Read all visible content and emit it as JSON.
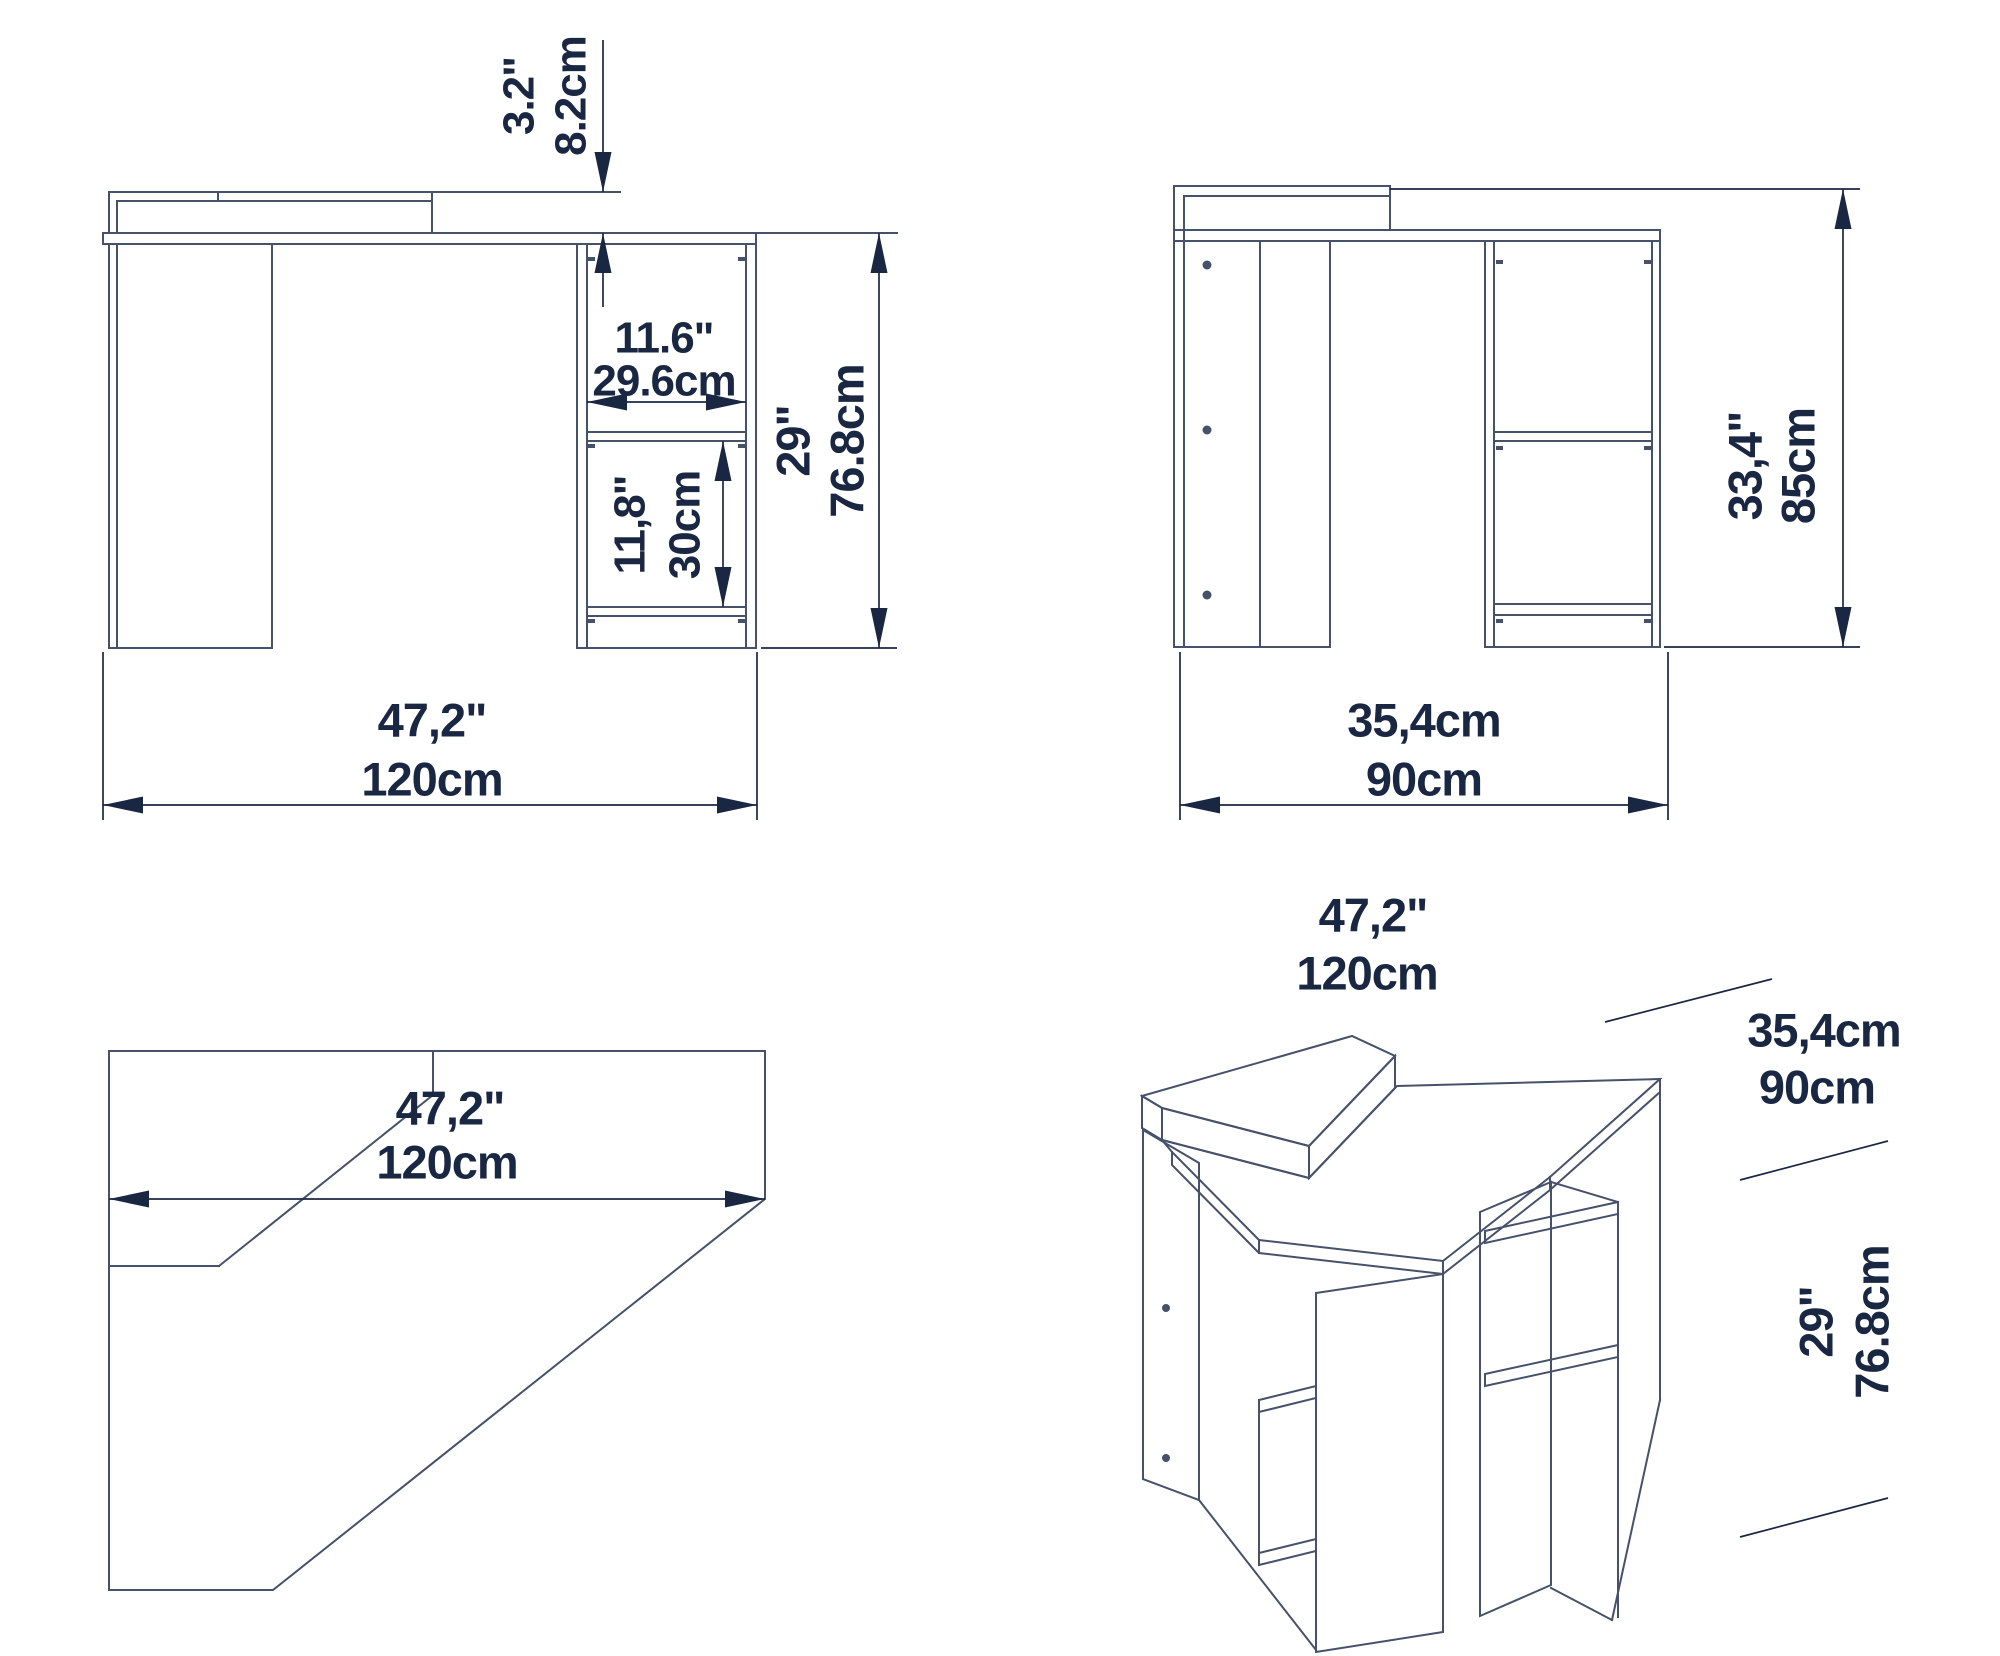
{
  "drawing_type": "furniture-technical-drawing",
  "subject": "corner-desk-with-shelves",
  "views": {
    "front": {
      "labels": {
        "shelf_height_in": "3.2\"",
        "shelf_height_cm": "8.2cm",
        "niche_width_in": "11.6\"",
        "niche_width_cm": "29.6cm",
        "niche_height_in": "11,8\"",
        "niche_height_cm": "30cm",
        "desk_height_in": "29\"",
        "desk_height_cm": "76.8cm",
        "width_in": "47,2\"",
        "width_cm": "120cm"
      }
    },
    "side": {
      "labels": {
        "total_height_in": "33,4\"",
        "total_height_cm": "85cm",
        "depth_in": "35,4cm",
        "depth_cm": "90cm"
      }
    },
    "top": {
      "labels": {
        "width_in": "47,2\"",
        "width_cm": "120cm"
      }
    },
    "iso": {
      "labels": {
        "width_in": "47,2\"",
        "width_cm": "120cm",
        "depth_in": "35,4cm",
        "depth_cm": "90cm",
        "height_in": "29\"",
        "height_cm": "76.8cm"
      }
    }
  },
  "colors": {
    "line": "#46516a",
    "dim": "#1a2742",
    "bg": "#ffffff",
    "border": "#c9cdd2"
  }
}
